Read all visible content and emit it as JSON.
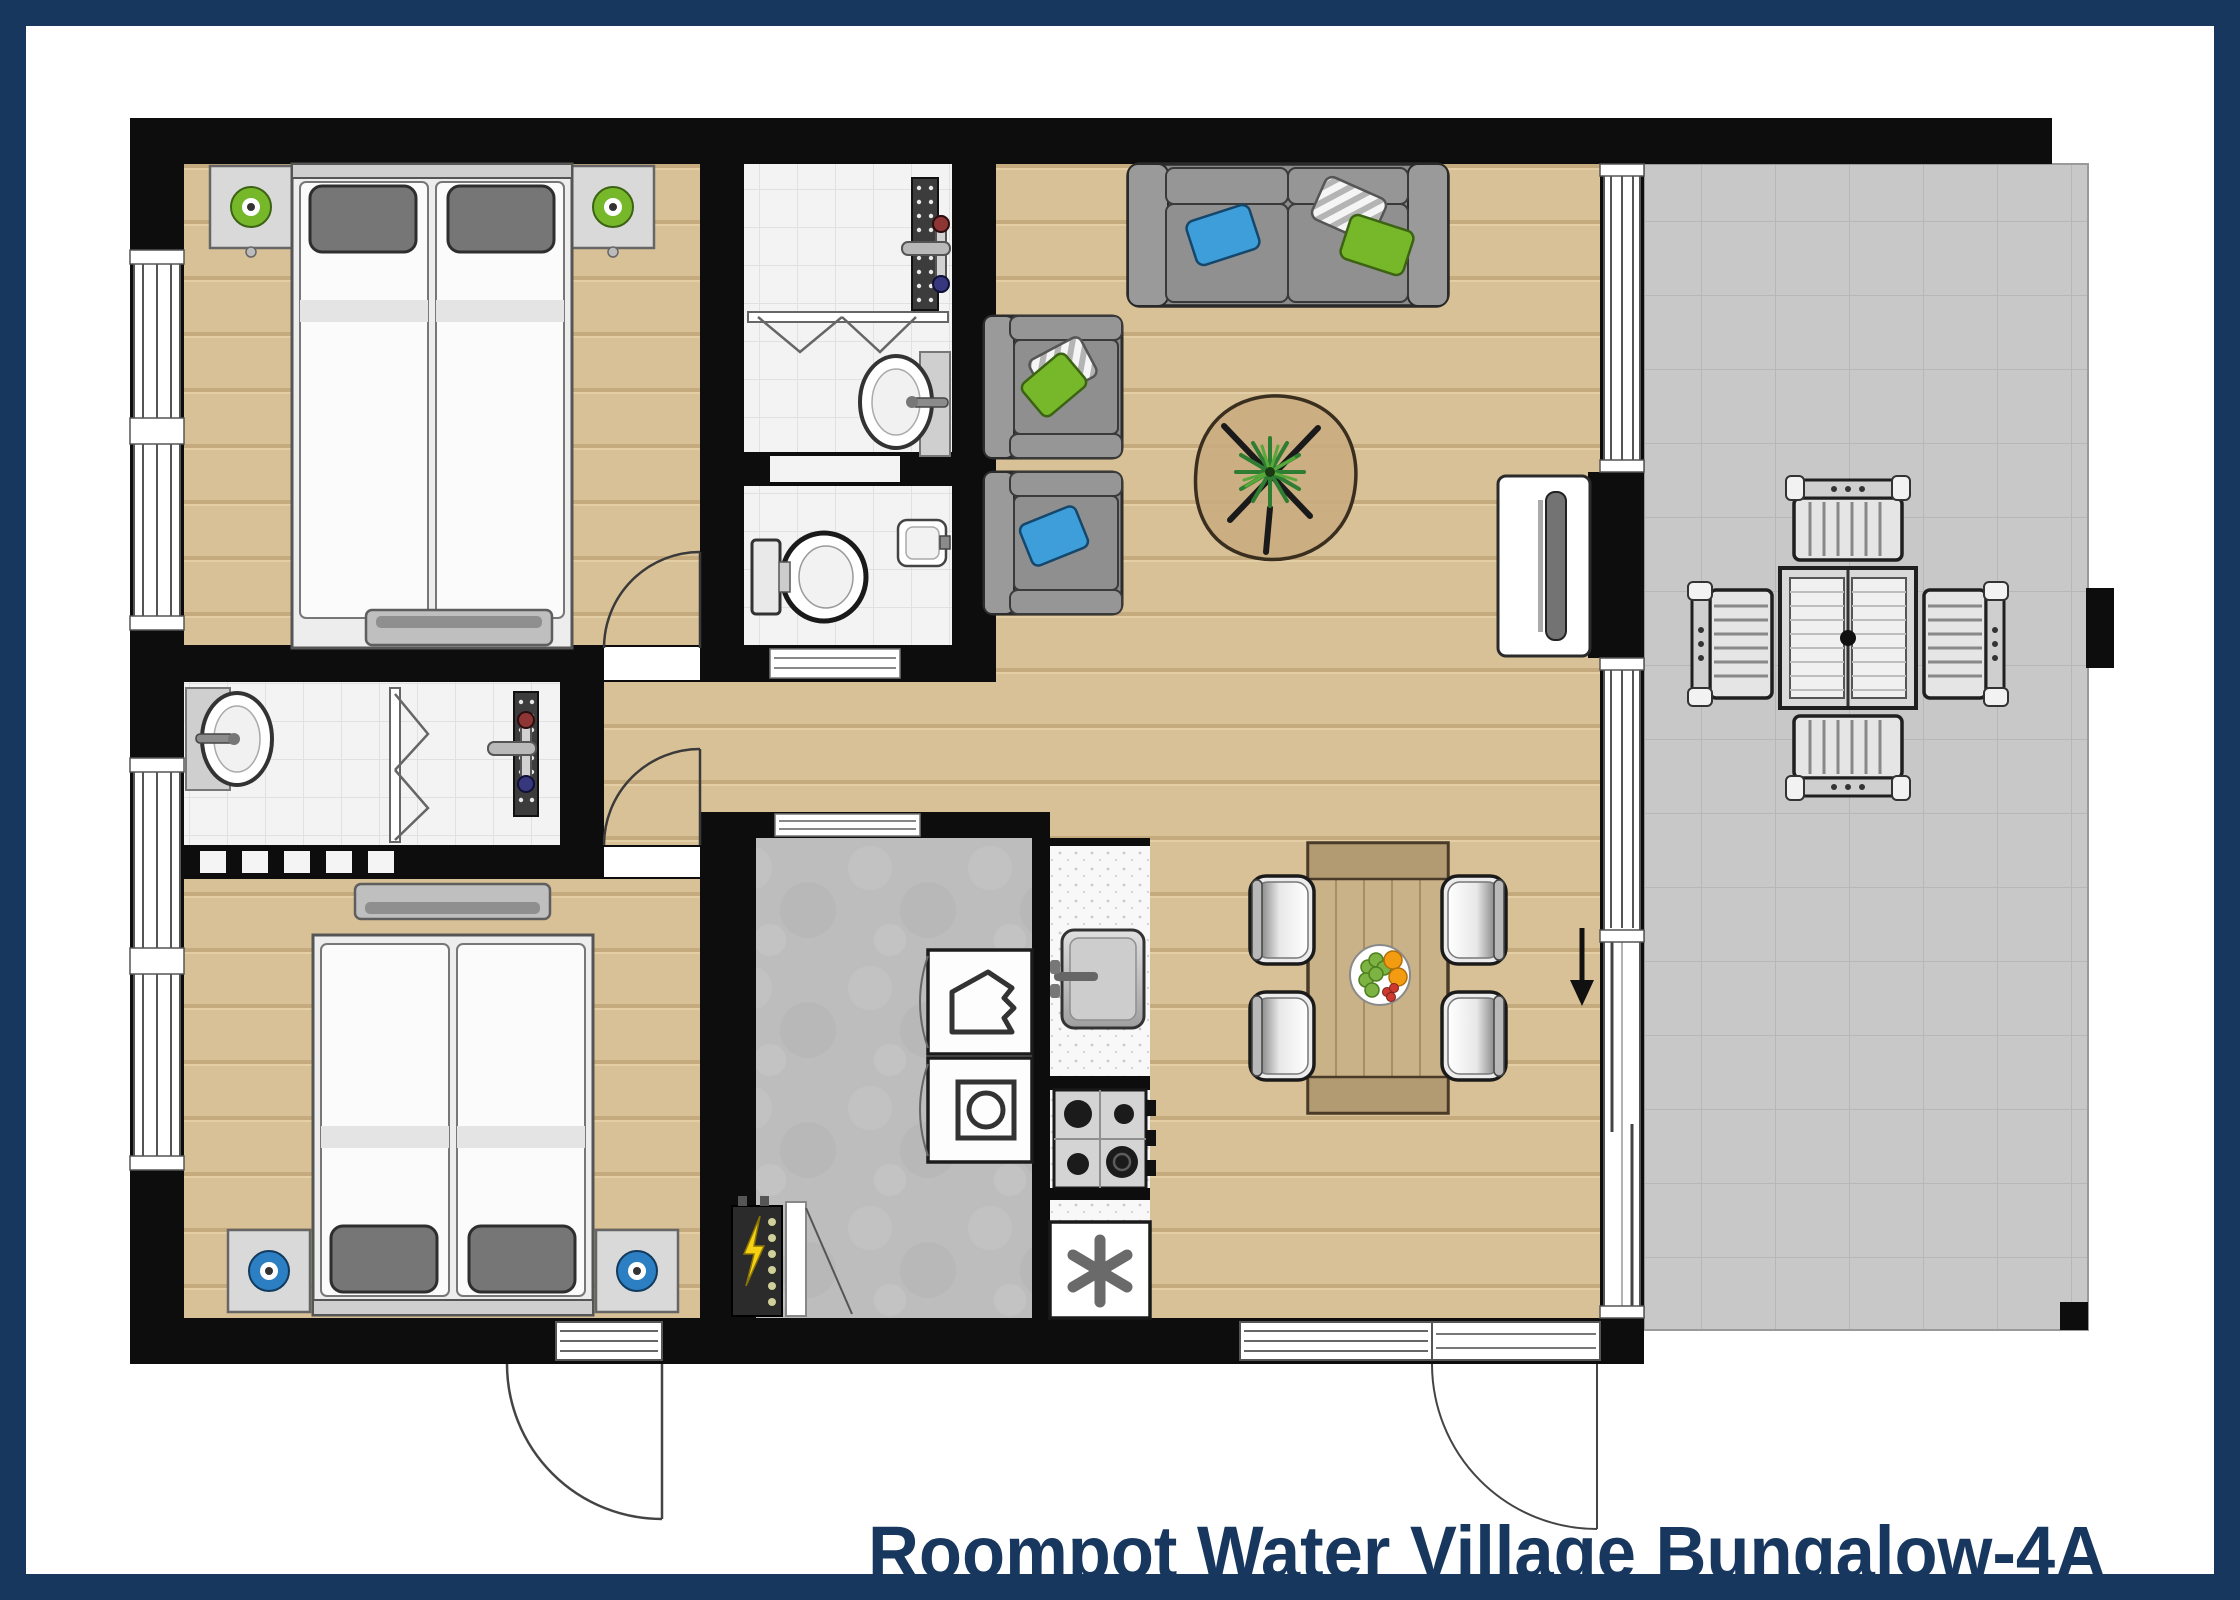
{
  "title": "Roompot Water Village Bungalow-4A",
  "palette": {
    "frame_border": "#17375E",
    "wall": "#0d0d0d",
    "wood_floor": "#d9c197",
    "tile_floor": "#f3f3f3",
    "concrete_floor": "#bdbdbd",
    "terrace_floor": "#c8c8c8",
    "counter": "#f8f8f8",
    "accent_green": "#76b82a",
    "accent_blue": "#3e9ed9",
    "lamp_blue": "#2b7fc2",
    "sofa_gray": "#8f8f8f",
    "table_wood": "#c9b188"
  },
  "rooms": [
    {
      "name": "Bedroom 1",
      "floor": "wood",
      "furniture": [
        "double bed (two singles)",
        "nightstand with green lamp (left)",
        "nightstand with green lamp (right)",
        "dresser",
        "window"
      ]
    },
    {
      "name": "Bathroom",
      "floor": "tile",
      "furniture": [
        "walk-in shower with drain",
        "shower mixer (hot/cold)",
        "bi-fold door",
        "washbasin"
      ]
    },
    {
      "name": "WC",
      "floor": "tile",
      "furniture": [
        "toilet",
        "corner washbasin"
      ]
    },
    {
      "name": "Shower room",
      "floor": "tile",
      "furniture": [
        "washbasin",
        "bi-fold door",
        "walk-in shower with drain",
        "shower mixer (hot/cold)"
      ]
    },
    {
      "name": "Bedroom 2",
      "floor": "wood",
      "furniture": [
        "double bed (two singles)",
        "nightstand with blue lamp (left)",
        "nightstand with blue lamp (right)",
        "dresser",
        "window"
      ]
    },
    {
      "name": "Hall / utility",
      "floor": "concrete",
      "furniture": [
        "dishwasher",
        "washing machine",
        "electrical panel",
        "entrance door"
      ]
    },
    {
      "name": "Kitchen",
      "floor": "wood",
      "furniture": [
        "sink unit",
        "4-burner hob",
        "freezer"
      ]
    },
    {
      "name": "Living / dining room",
      "floor": "wood",
      "furniture": [
        "sofa with blue, striped and green cushions",
        "armchair with green and striped cushions",
        "armchair with blue cushion",
        "coffee table with plant",
        "TV on cabinet",
        "dining table",
        "4 dining chairs",
        "fruit bowl",
        "sliding door to terrace"
      ]
    },
    {
      "name": "Terrace",
      "floor": "tiles",
      "furniture": [
        "outdoor table",
        "4 outdoor chairs"
      ]
    }
  ]
}
